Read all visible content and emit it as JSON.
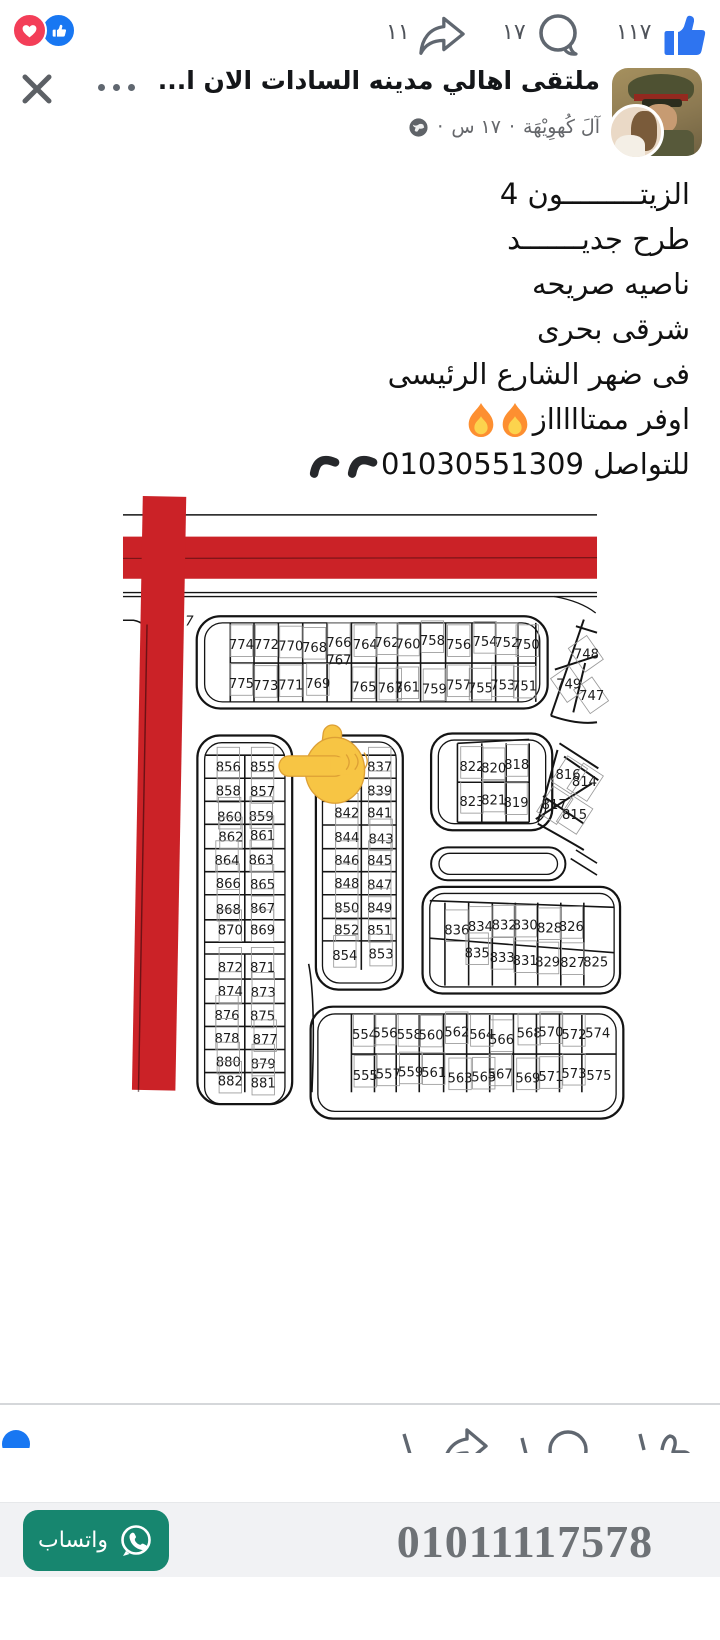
{
  "reactions_bar": {
    "share_count": "١١",
    "comment_count": "١٧",
    "like_count": "١١٧"
  },
  "post_header": {
    "title": "ملتقى اهالي مدينه السادات الان ا...",
    "author": "آلَ كُهوِيْهَة",
    "separator": "·",
    "time": "١٧ س"
  },
  "post_text": {
    "lines": [
      {
        "text": "الزيتـــــــــون 4"
      },
      {
        "text": "طرح جديـــــــد"
      },
      {
        "text": "ناصيه صريحه"
      },
      {
        "text": "شرقى بحرى"
      },
      {
        "text": "فى ضهر الشارع الرئيسى"
      },
      {
        "text": "اوفر ممتاااااز"
      },
      {
        "text": "للتواصل 01030551309"
      }
    ]
  },
  "map": {
    "plot_labels": [
      {
        "n": "7",
        "x": 101,
        "y": 694,
        "nr": 1,
        "i": 1
      },
      {
        "n": "774",
        "x": 180,
        "y": 730
      },
      {
        "n": "772",
        "x": 218,
        "y": 730
      },
      {
        "n": "770",
        "x": 255,
        "y": 732
      },
      {
        "n": "768",
        "x": 291,
        "y": 734
      },
      {
        "n": "766",
        "x": 328,
        "y": 727
      },
      {
        "n": "767",
        "x": 328,
        "y": 753,
        "nr": 1
      },
      {
        "n": "764",
        "x": 368,
        "y": 730
      },
      {
        "n": "762",
        "x": 401,
        "y": 727
      },
      {
        "n": "760",
        "x": 433,
        "y": 729
      },
      {
        "n": "758",
        "x": 470,
        "y": 724
      },
      {
        "n": "756",
        "x": 510,
        "y": 730
      },
      {
        "n": "754",
        "x": 550,
        "y": 725
      },
      {
        "n": "752",
        "x": 583,
        "y": 727
      },
      {
        "n": "750",
        "x": 614,
        "y": 730
      },
      {
        "n": "775",
        "x": 180,
        "y": 789
      },
      {
        "n": "773",
        "x": 217,
        "y": 792
      },
      {
        "n": "771",
        "x": 255,
        "y": 791
      },
      {
        "n": "769",
        "x": 296,
        "y": 789
      },
      {
        "n": "765",
        "x": 366,
        "y": 794
      },
      {
        "n": "763",
        "x": 406,
        "y": 796
      },
      {
        "n": "761",
        "x": 432,
        "y": 794
      },
      {
        "n": "759",
        "x": 473,
        "y": 797
      },
      {
        "n": "757",
        "x": 510,
        "y": 791
      },
      {
        "n": "755",
        "x": 543,
        "y": 796
      },
      {
        "n": "753",
        "x": 577,
        "y": 791
      },
      {
        "n": "751",
        "x": 610,
        "y": 793
      },
      {
        "n": "748",
        "x": 704,
        "y": 744,
        "nr": 1
      },
      {
        "n": "749",
        "x": 677,
        "y": 790,
        "nr": 1
      },
      {
        "n": "747",
        "x": 712,
        "y": 807,
        "nr": 1
      },
      {
        "n": "856",
        "x": 160,
        "y": 916
      },
      {
        "n": "855",
        "x": 212,
        "y": 916
      },
      {
        "n": "858",
        "x": 160,
        "y": 952
      },
      {
        "n": "857",
        "x": 212,
        "y": 953
      },
      {
        "n": "860",
        "x": 162,
        "y": 992
      },
      {
        "n": "859",
        "x": 210,
        "y": 991
      },
      {
        "n": "862",
        "x": 164,
        "y": 1022
      },
      {
        "n": "861",
        "x": 212,
        "y": 1020
      },
      {
        "n": "864",
        "x": 158,
        "y": 1058
      },
      {
        "n": "863",
        "x": 210,
        "y": 1057
      },
      {
        "n": "866",
        "x": 160,
        "y": 1093
      },
      {
        "n": "865",
        "x": 212,
        "y": 1094
      },
      {
        "n": "868",
        "x": 160,
        "y": 1132
      },
      {
        "n": "867",
        "x": 212,
        "y": 1131
      },
      {
        "n": "870",
        "x": 163,
        "y": 1163
      },
      {
        "n": "869",
        "x": 212,
        "y": 1163
      },
      {
        "n": "872",
        "x": 163,
        "y": 1220
      },
      {
        "n": "871",
        "x": 212,
        "y": 1220
      },
      {
        "n": "874",
        "x": 163,
        "y": 1257
      },
      {
        "n": "873",
        "x": 213,
        "y": 1258
      },
      {
        "n": "876",
        "x": 158,
        "y": 1293
      },
      {
        "n": "875",
        "x": 212,
        "y": 1294
      },
      {
        "n": "878",
        "x": 158,
        "y": 1328
      },
      {
        "n": "877",
        "x": 216,
        "y": 1330
      },
      {
        "n": "880",
        "x": 160,
        "y": 1364
      },
      {
        "n": "879",
        "x": 213,
        "y": 1367
      },
      {
        "n": "882",
        "x": 163,
        "y": 1393
      },
      {
        "n": "881",
        "x": 213,
        "y": 1396
      },
      {
        "n": "838",
        "x": 337,
        "y": 916
      },
      {
        "n": "837",
        "x": 390,
        "y": 916
      },
      {
        "n": "839",
        "x": 390,
        "y": 952
      },
      {
        "n": "842",
        "x": 340,
        "y": 986
      },
      {
        "n": "841",
        "x": 390,
        "y": 986
      },
      {
        "n": "844",
        "x": 340,
        "y": 1023
      },
      {
        "n": "843",
        "x": 392,
        "y": 1025
      },
      {
        "n": "846",
        "x": 340,
        "y": 1058
      },
      {
        "n": "845",
        "x": 390,
        "y": 1058
      },
      {
        "n": "848",
        "x": 340,
        "y": 1093
      },
      {
        "n": "847",
        "x": 390,
        "y": 1095
      },
      {
        "n": "850",
        "x": 340,
        "y": 1130
      },
      {
        "n": "849",
        "x": 390,
        "y": 1130
      },
      {
        "n": "852",
        "x": 340,
        "y": 1163
      },
      {
        "n": "851",
        "x": 390,
        "y": 1164
      },
      {
        "n": "854",
        "x": 337,
        "y": 1202
      },
      {
        "n": "853",
        "x": 392,
        "y": 1200
      },
      {
        "n": "822",
        "x": 530,
        "y": 915
      },
      {
        "n": "820",
        "x": 563,
        "y": 917
      },
      {
        "n": "818",
        "x": 598,
        "y": 912
      },
      {
        "n": "823",
        "x": 530,
        "y": 968
      },
      {
        "n": "821",
        "x": 563,
        "y": 966
      },
      {
        "n": "819",
        "x": 597,
        "y": 970
      },
      {
        "n": "816",
        "x": 676,
        "y": 927,
        "nr": 1
      },
      {
        "n": "814",
        "x": 701,
        "y": 938,
        "nr": 1
      },
      {
        "n": "817",
        "x": 655,
        "y": 973,
        "nr": 1
      },
      {
        "n": "815",
        "x": 686,
        "y": 988,
        "nr": 1
      },
      {
        "n": "836",
        "x": 507,
        "y": 1163
      },
      {
        "n": "834",
        "x": 543,
        "y": 1158
      },
      {
        "n": "832",
        "x": 579,
        "y": 1156
      },
      {
        "n": "830",
        "x": 611,
        "y": 1156
      },
      {
        "n": "828",
        "x": 648,
        "y": 1160
      },
      {
        "n": "826",
        "x": 681,
        "y": 1158
      },
      {
        "n": "835",
        "x": 538,
        "y": 1198
      },
      {
        "n": "833",
        "x": 576,
        "y": 1205
      },
      {
        "n": "831",
        "x": 611,
        "y": 1210
      },
      {
        "n": "829",
        "x": 645,
        "y": 1212
      },
      {
        "n": "827",
        "x": 683,
        "y": 1213
      },
      {
        "n": "825",
        "x": 718,
        "y": 1212,
        "nr": 1
      },
      {
        "n": "554",
        "x": 367,
        "y": 1322
      },
      {
        "n": "556",
        "x": 398,
        "y": 1320
      },
      {
        "n": "558",
        "x": 435,
        "y": 1322
      },
      {
        "n": "560",
        "x": 468,
        "y": 1323
      },
      {
        "n": "562",
        "x": 507,
        "y": 1318
      },
      {
        "n": "564",
        "x": 545,
        "y": 1322
      },
      {
        "n": "566",
        "x": 575,
        "y": 1330
      },
      {
        "n": "568",
        "x": 617,
        "y": 1320
      },
      {
        "n": "570",
        "x": 650,
        "y": 1318
      },
      {
        "n": "572",
        "x": 685,
        "y": 1322
      },
      {
        "n": "574",
        "x": 721,
        "y": 1320,
        "nr": 1
      },
      {
        "n": "555",
        "x": 368,
        "y": 1384
      },
      {
        "n": "557",
        "x": 403,
        "y": 1382
      },
      {
        "n": "559",
        "x": 437,
        "y": 1379
      },
      {
        "n": "561",
        "x": 472,
        "y": 1380
      },
      {
        "n": "563",
        "x": 512,
        "y": 1388
      },
      {
        "n": "565",
        "x": 548,
        "y": 1387
      },
      {
        "n": "567",
        "x": 573,
        "y": 1382
      },
      {
        "n": "569",
        "x": 615,
        "y": 1388
      },
      {
        "n": "571",
        "x": 650,
        "y": 1386
      },
      {
        "n": "573",
        "x": 685,
        "y": 1381
      },
      {
        "n": "575",
        "x": 723,
        "y": 1384,
        "nr": 1
      }
    ]
  },
  "footer": {
    "phone": "01011117578",
    "whatsapp_label": "واتساب"
  },
  "colors": {
    "road_red": "#cb2227",
    "facebook_blue": "#2e74f0",
    "badge_blue": "#1877f2",
    "love_red": "#f33e58",
    "whatsapp_green": "#17866f"
  }
}
